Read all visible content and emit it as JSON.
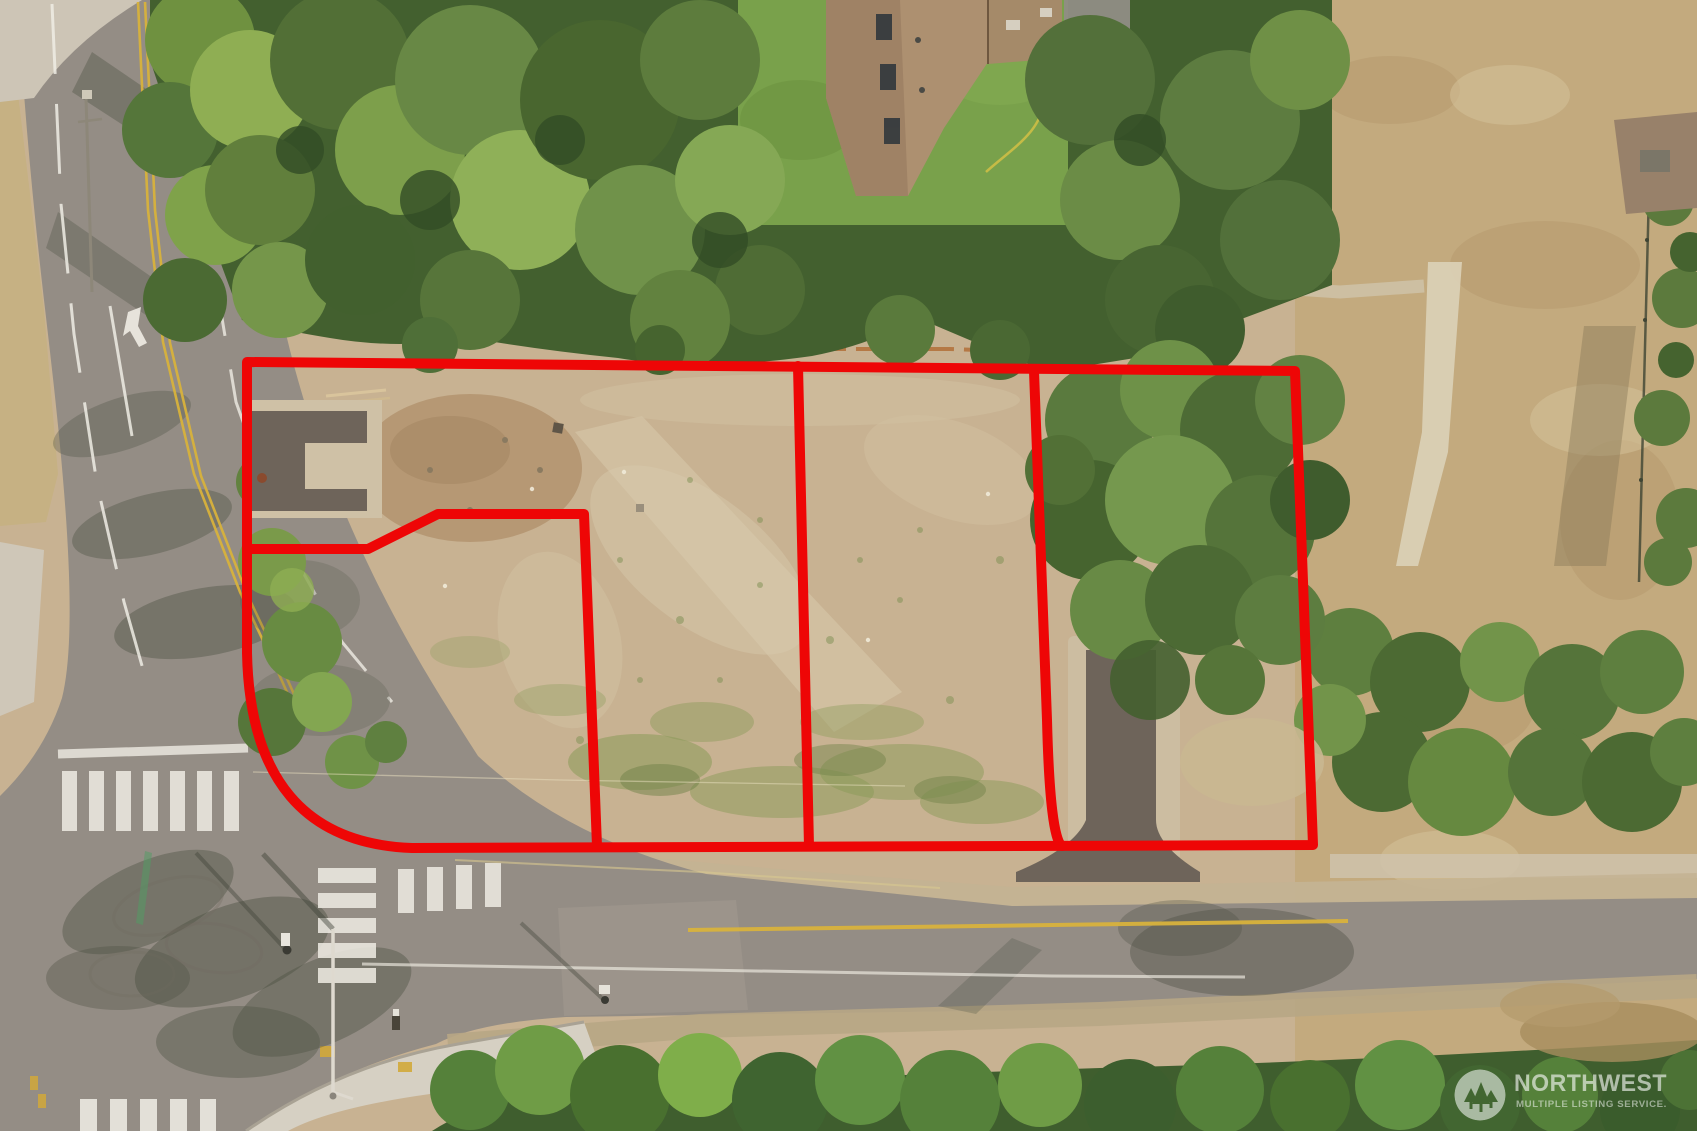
{
  "image": {
    "kind": "aerial-drone-photo",
    "subject": "Cleared vacant land with four surveyed parcels outlined in red beside a street intersection",
    "width_px": 1697,
    "height_px": 1131
  },
  "watermark": {
    "brand": "NORTHWEST",
    "tagline": "MULTIPLE LISTING SERVICE.",
    "logo_icon": "evergreen-trees-in-circle",
    "text_color": "#ffffff",
    "opacity": 0.55
  },
  "overlay": {
    "stroke_color": "#ee0606",
    "stroke_width": 10,
    "parcel_count": 4,
    "outer_boundary_path": "M 247,362 L 1295,371 L 1313,845 L 412,848 Q 251,842 247,653 Z",
    "divider_paths": {
      "lot1_east": "M 247,549 L 368,549 L 438,514 L 584,514 L 597,846",
      "lot2_east": "M 798,366 L 809,846",
      "lot3_east": "M 1034,371 L 1047,720 Q 1050,838 1062,846"
    }
  },
  "scene": {
    "palette": {
      "dirt": "#c8b292",
      "dry_field": "#c3aa7e",
      "asphalt": "#948d85",
      "gravel_shoulder": "#c4b394",
      "concrete": "#d6d0c3",
      "forest_dark": "#43602f",
      "forest_mid": "#64823f",
      "forest_light": "#8fae53",
      "lawn": "#79a14b",
      "roof_tan": "#ad9070",
      "marking_white": "#efece4",
      "marking_yellow": "#d8b23c",
      "driveway_asphalt": "#6e645a"
    },
    "features": [
      "dense evergreen canopy along north edge",
      "cleared gravel lot outlined as four parcels",
      "T street intersection with ladder crosswalks",
      "two dark asphalt driveway aprons",
      "neighboring house roofs and lawn",
      "dry grass field with footpath and fence line",
      "NWMLS watermark lower right"
    ]
  }
}
